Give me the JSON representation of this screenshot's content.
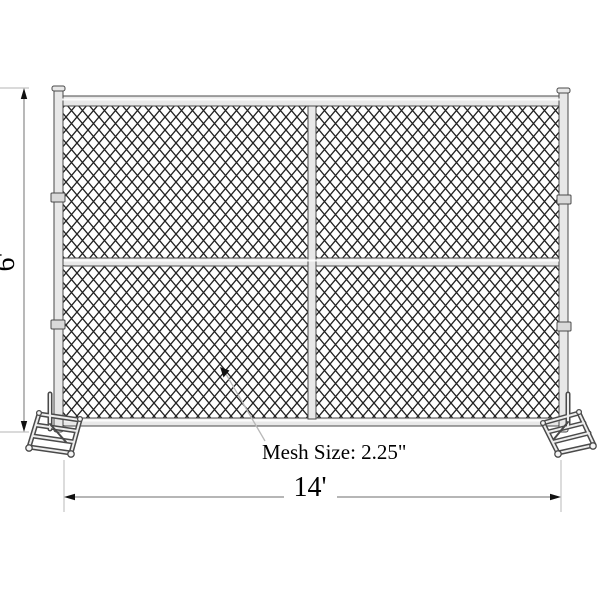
{
  "diagram": {
    "labels": {
      "height": "6'",
      "width": "14'",
      "mesh_size": "Mesh Size: 2.25\""
    },
    "colors": {
      "background": "#ffffff",
      "mesh_wire": "#222222",
      "metal_fill": "#e8e8e8",
      "metal_outline": "#4a4a4a",
      "clamp_fill": "#d9d9d9",
      "dimension_line": "#8a8a8a",
      "extension_line": "#c4c4c4",
      "leader_line": "#b8b8b8",
      "arrowhead": "#111111",
      "text": "#000000"
    }
  }
}
